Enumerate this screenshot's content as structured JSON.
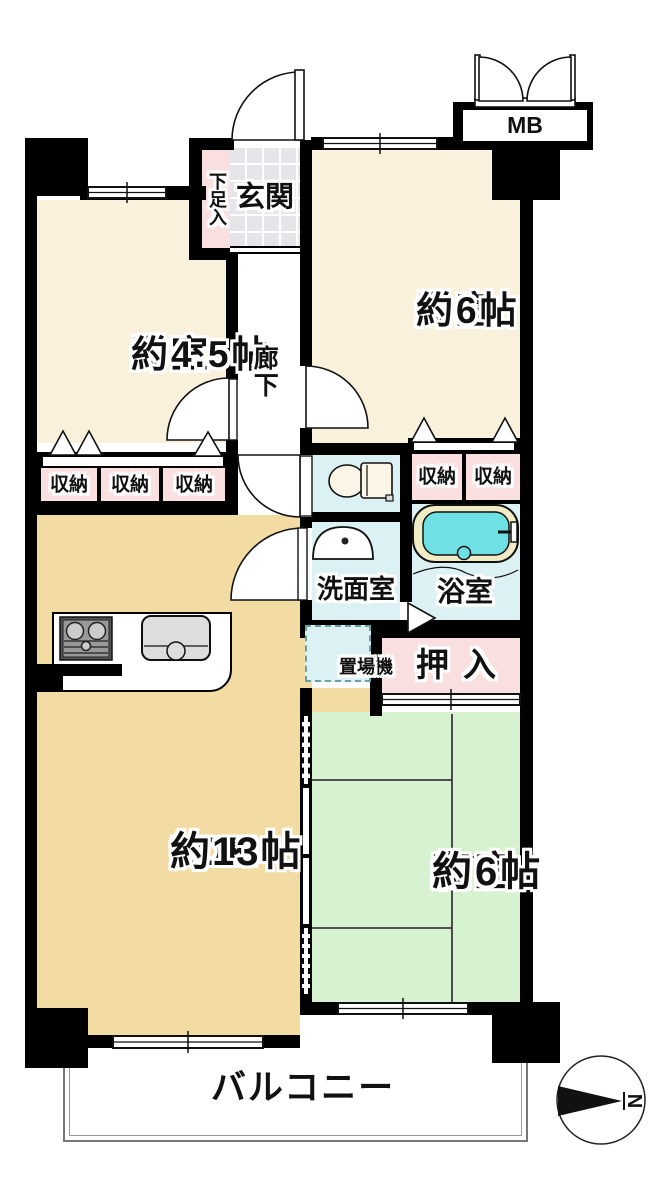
{
  "floorplan": {
    "rooms": {
      "western_room_45": {
        "name": "洋室",
        "size": "約4.5帖"
      },
      "western_room_6": {
        "name": "洋室",
        "size": "約6帖"
      },
      "japanese_room": {
        "name": "和室",
        "size": "約6帖"
      },
      "ldk": {
        "name": "LDK",
        "size": "約13帖"
      },
      "entrance": {
        "label": "玄関"
      },
      "shoe_cabinet": {
        "label": "下足入"
      },
      "hallway": {
        "label": "廊下"
      },
      "washroom": {
        "label": "洗面室"
      },
      "bathroom": {
        "label": "浴室"
      },
      "laundry": {
        "line1": "洗濯機",
        "line2": "置場"
      },
      "futon_closet": {
        "label": "押入"
      },
      "balcony": {
        "label": "バルコニー"
      },
      "meter_box": {
        "label": "MB"
      }
    },
    "storages": [
      "収納",
      "収納",
      "収納",
      "収納",
      "収納"
    ],
    "compass": {
      "north": "N"
    },
    "colors": {
      "wall": "#000000",
      "western_room": "#FAF1DC",
      "ldk": "#F2DCA4",
      "japanese_room": "#D6F2D0",
      "wet_area": "#DCF1F3",
      "storage_pink": "#F9DFDF",
      "entrance_tile": "#E6E6EA",
      "bath_water": "#6FE0E4",
      "tub_rim": "#F2ECC6"
    }
  }
}
